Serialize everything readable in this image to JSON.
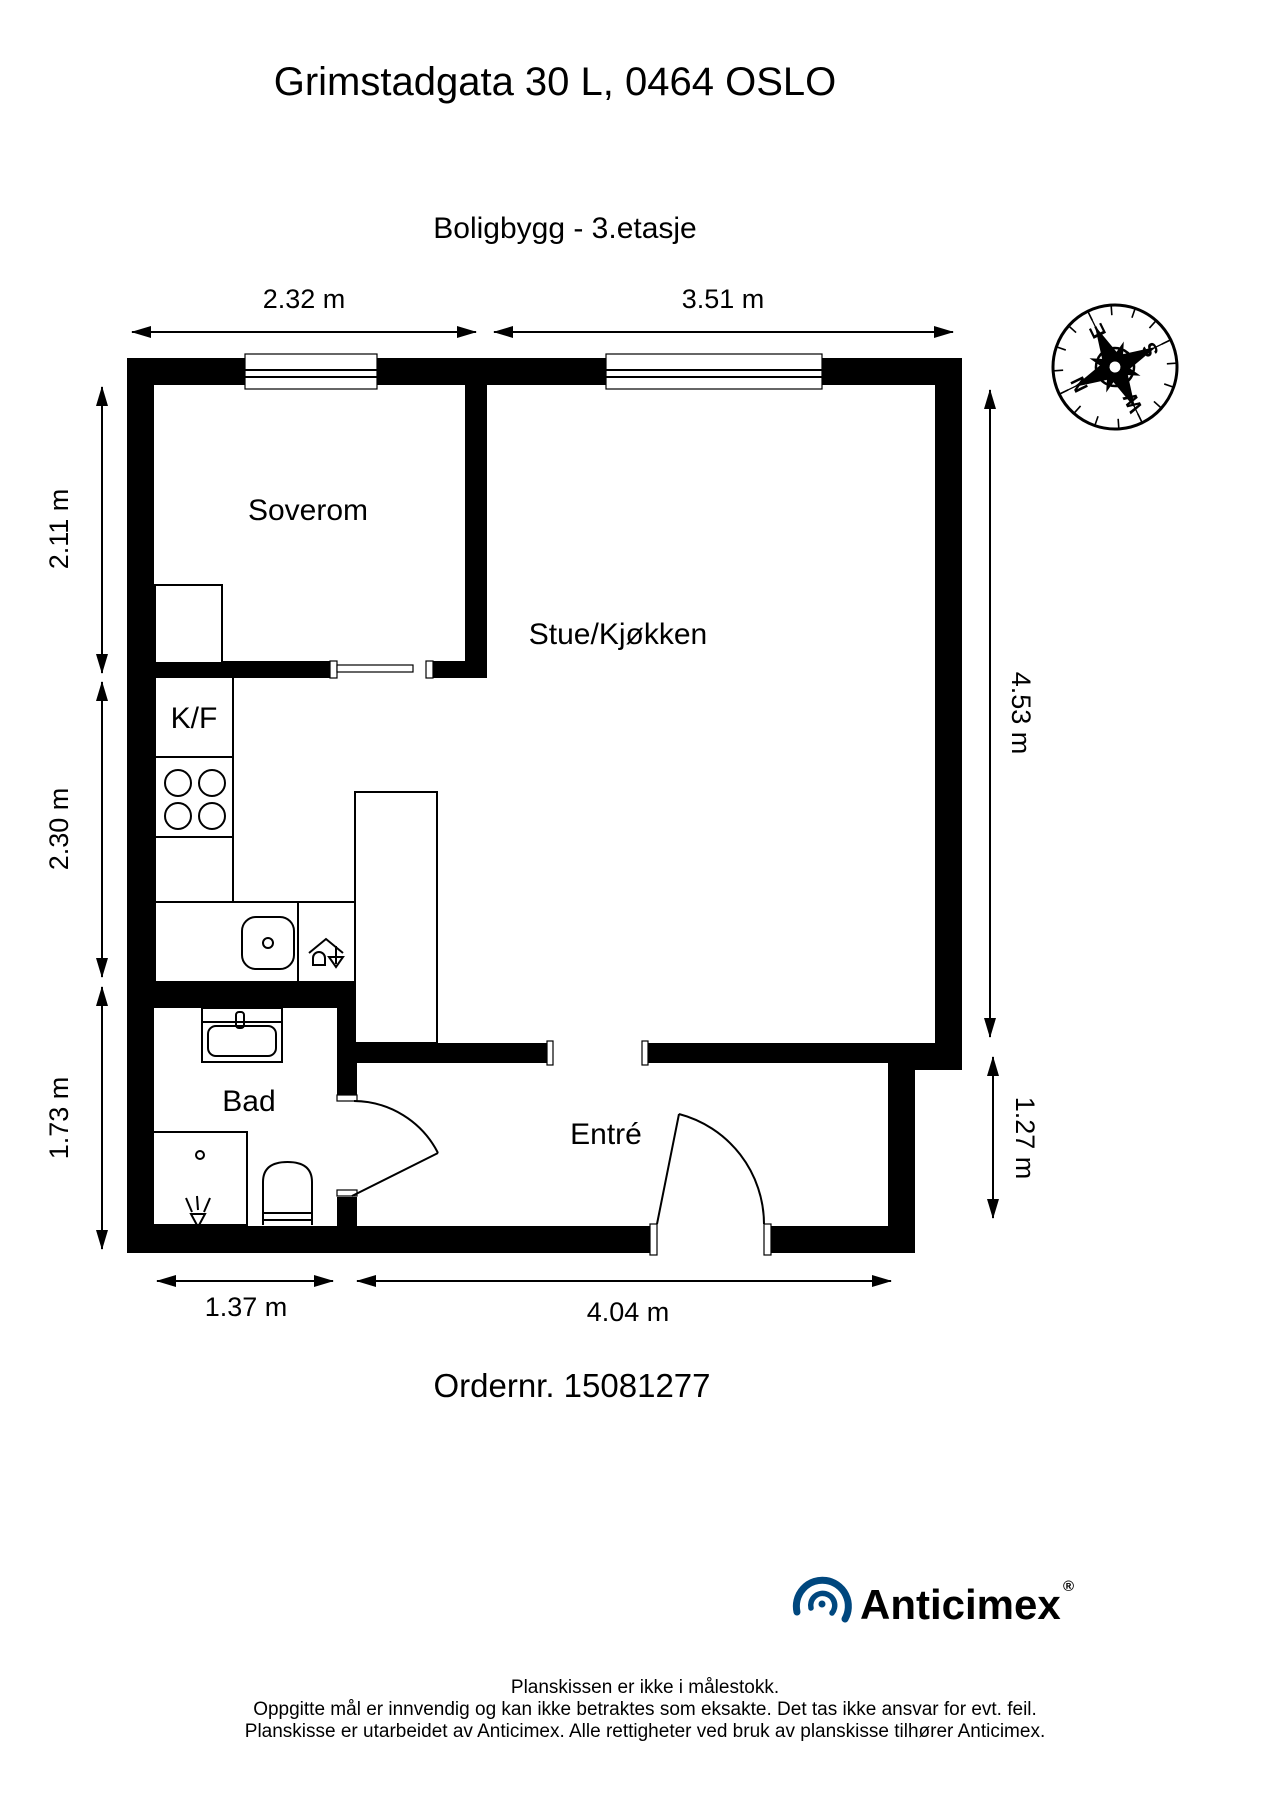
{
  "header": {
    "title": "Grimstadgata 30 L, 0464 OSLO",
    "subtitle": "Boligbygg - 3.etasje"
  },
  "rooms": {
    "bedroom": "Soverom",
    "living_kitchen": "Stue/Kjøkken",
    "fridge_freezer": "K/F",
    "bathroom": "Bad",
    "entry": "Entré"
  },
  "dimensions": {
    "top_left": "2.32 m",
    "top_right": "3.51 m",
    "left_upper": "2.11 m",
    "left_middle": "2.30 m",
    "left_lower": "1.73 m",
    "right_upper": "4.53 m",
    "right_lower": "1.27 m",
    "bottom_left": "1.37 m",
    "bottom_right": "4.04 m"
  },
  "compass": {
    "n": "N",
    "e": "E",
    "s": "S",
    "w": "W"
  },
  "order": {
    "label": "Ordernr. 15081277"
  },
  "footer": {
    "brand": "Anticimex",
    "registered": "®",
    "disclaimer_1": "Planskissen er ikke i målestokk.",
    "disclaimer_2": "Oppgitte mål er innvendig og kan ikke betraktes som eksakte. Det tas ikke ansvar for evt. feil.",
    "disclaimer_3": "Planskisse er utarbeidet av Anticimex. Alle rettigheter ved bruk av planskisse tilhører Anticimex."
  },
  "colors": {
    "brand_blue": "#00477e",
    "ink": "#000000"
  }
}
